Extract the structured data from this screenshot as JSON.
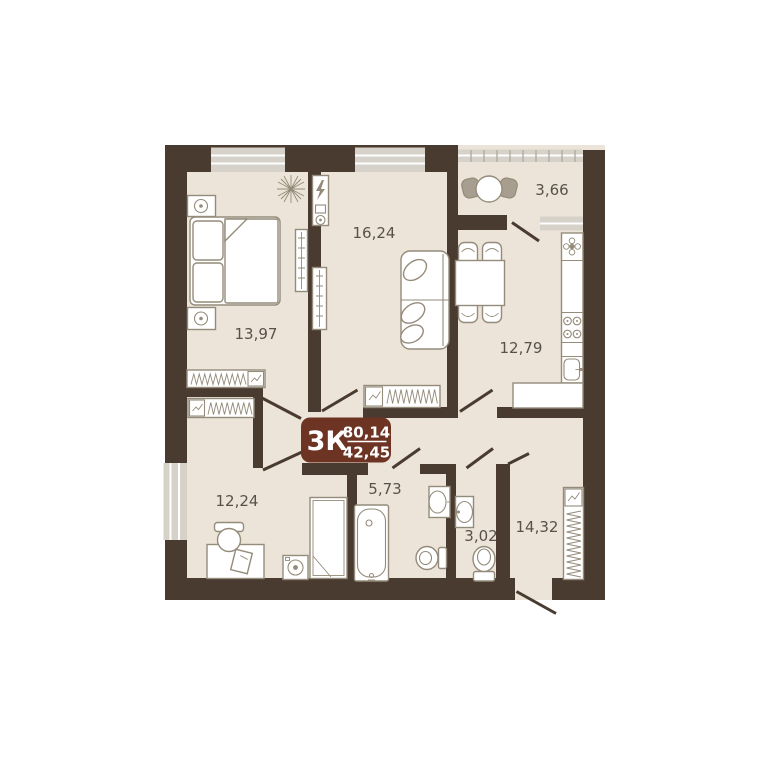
{
  "plan": {
    "badge": {
      "type": "3К",
      "total_area": "80,14",
      "living_area": "42,45"
    },
    "rooms": [
      {
        "id": "bedroom",
        "area": "13,97"
      },
      {
        "id": "living-room",
        "area": "16,24"
      },
      {
        "id": "balcony",
        "area": "3,66"
      },
      {
        "id": "kitchen",
        "area": "12,79"
      },
      {
        "id": "room",
        "area": "12,24"
      },
      {
        "id": "bathroom",
        "area": "5,73"
      },
      {
        "id": "wc",
        "area": "3,02"
      },
      {
        "id": "hallway",
        "area": "14,32"
      }
    ],
    "colors": {
      "wall": "#4a3b30",
      "floor": "#ece4d8",
      "outline": "#948b7a",
      "window": "#d6d2c9",
      "label": "#58514a",
      "badgebg": "#6e3423",
      "badgetext": "#ffffff",
      "furniture": "#ffffff",
      "chairfill": "#a89e90"
    }
  }
}
